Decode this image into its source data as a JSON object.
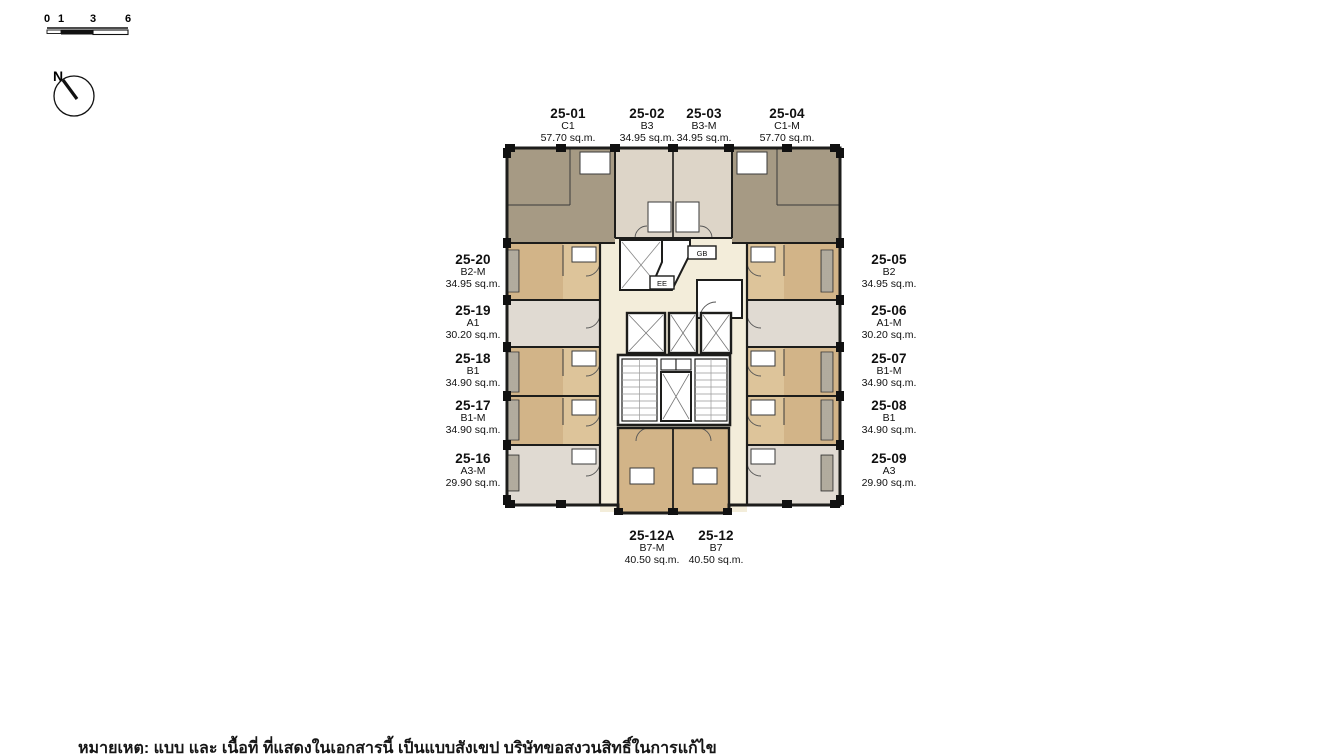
{
  "scale_bar": {
    "ticks": [
      "0",
      "1",
      "3",
      "6"
    ]
  },
  "compass": {
    "label": "N"
  },
  "floor_plan": {
    "core": {
      "gb_label": "GB",
      "ee_label": "EE"
    },
    "units": {
      "top": [
        {
          "id": "25-01",
          "type": "C1",
          "area": "57.70 sq.m."
        },
        {
          "id": "25-02",
          "type": "B3",
          "area": "34.95 sq.m."
        },
        {
          "id": "25-03",
          "type": "B3-M",
          "area": "34.95 sq.m."
        },
        {
          "id": "25-04",
          "type": "C1-M",
          "area": "57.70 sq.m."
        }
      ],
      "left": [
        {
          "id": "25-20",
          "type": "B2-M",
          "area": "34.95 sq.m."
        },
        {
          "id": "25-19",
          "type": "A1",
          "area": "30.20 sq.m."
        },
        {
          "id": "25-18",
          "type": "B1",
          "area": "34.90 sq.m."
        },
        {
          "id": "25-17",
          "type": "B1-M",
          "area": "34.90 sq.m."
        },
        {
          "id": "25-16",
          "type": "A3-M",
          "area": "29.90 sq.m."
        }
      ],
      "right": [
        {
          "id": "25-05",
          "type": "B2",
          "area": "34.95 sq.m."
        },
        {
          "id": "25-06",
          "type": "A1-M",
          "area": "30.20 sq.m."
        },
        {
          "id": "25-07",
          "type": "B1-M",
          "area": "34.90 sq.m."
        },
        {
          "id": "25-08",
          "type": "B1",
          "area": "34.90 sq.m."
        },
        {
          "id": "25-09",
          "type": "A3",
          "area": "29.90 sq.m."
        }
      ],
      "bottom": [
        {
          "id": "25-12A",
          "type": "B7-M",
          "area": "40.50 sq.m."
        },
        {
          "id": "25-12",
          "type": "B7",
          "area": "40.50 sq.m."
        }
      ]
    },
    "colors": {
      "unit_grey": "#a69a84",
      "unit_tan": "#d2b488",
      "unit_tan_light": "#ddc49a",
      "unit_pink_beige": "#ddd5c8",
      "unit_light": "#e0dad2",
      "core_cream": "#f3edda",
      "wall": "#1d1d1b",
      "room_white": "#ffffff"
    }
  },
  "footnote": "หมายเหตุ: แบบ และ เนื้อที่ ที่แสดงในเอกสารนี้ เป็นแบบสังเขป บริษัทขอสงวนสิทธิ์ในการแก้ไข"
}
